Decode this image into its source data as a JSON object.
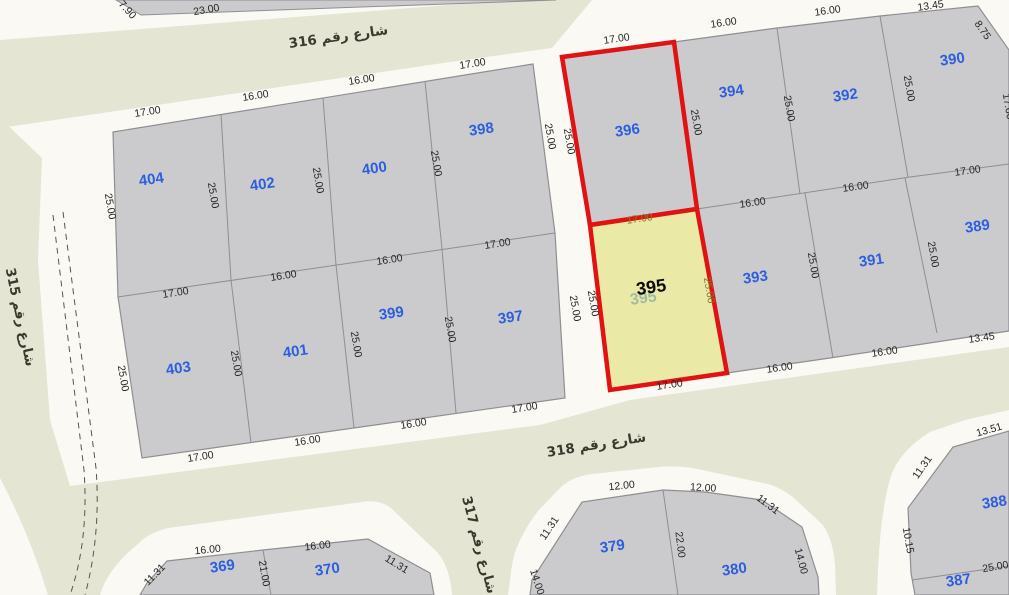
{
  "map": {
    "colors": {
      "background": "#f8f7f2",
      "street_green": "#e4e6d3",
      "block_pad_white": "#faf9f4",
      "parcel_fill": "#cbcbcd",
      "parcel_stroke": "#8f8f92",
      "highlight_red": "#e01212",
      "selected_yellow": "#ebe9a6",
      "parcel_number_blue": "#2d5ee0",
      "dimension_text": "#262626",
      "olive_dimension_text": "#7e7e2e",
      "street_text": "#3a392d"
    },
    "streets": [
      {
        "number": "316",
        "name": "شارع رقم 316",
        "x": 339,
        "y": 41,
        "rot": -8
      },
      {
        "number": "315",
        "name": "شارع رقم 315",
        "x": 16,
        "y": 318,
        "rot": 78
      },
      {
        "number": "318",
        "name": "شارع رقم 318",
        "x": 597,
        "y": 449,
        "rot": -9
      },
      {
        "number": "317",
        "name": "شارع رقم 317",
        "x": 475,
        "y": 546,
        "rot": 75
      }
    ],
    "parcels": [
      {
        "num": "404",
        "x": 152,
        "y": 184
      },
      {
        "num": "402",
        "x": 263,
        "y": 189
      },
      {
        "num": "400",
        "x": 375,
        "y": 173
      },
      {
        "num": "398",
        "x": 482,
        "y": 134
      },
      {
        "num": "403",
        "x": 179,
        "y": 373
      },
      {
        "num": "401",
        "x": 296,
        "y": 356
      },
      {
        "num": "399",
        "x": 392,
        "y": 318
      },
      {
        "num": "397",
        "x": 511,
        "y": 322
      },
      {
        "num": "396",
        "x": 628,
        "y": 135
      },
      {
        "num": "394",
        "x": 732,
        "y": 96
      },
      {
        "num": "392",
        "x": 846,
        "y": 100
      },
      {
        "num": "390",
        "x": 953,
        "y": 64
      },
      {
        "num": "393",
        "x": 756,
        "y": 282
      },
      {
        "num": "391",
        "x": 872,
        "y": 265
      },
      {
        "num": "389",
        "x": 978,
        "y": 231
      },
      {
        "num": "369",
        "x": 223,
        "y": 571
      },
      {
        "num": "370",
        "x": 328,
        "y": 574
      },
      {
        "num": "379",
        "x": 613,
        "y": 551
      },
      {
        "num": "380",
        "x": 735,
        "y": 574
      },
      {
        "num": "387",
        "x": 959,
        "y": 585
      },
      {
        "num": "388",
        "x": 995,
        "y": 507
      }
    ],
    "selected": {
      "number": "395",
      "x": 652,
      "y": 293,
      "ghost_number": "395",
      "ghost_x": 644,
      "ghost_y": 303
    },
    "dims": [
      {
        "t": "7.90",
        "x": 125,
        "y": 12,
        "r": 48
      },
      {
        "t": "23.00",
        "x": 207,
        "y": 13,
        "r": -10
      },
      {
        "t": "17.00",
        "x": 148,
        "y": 115,
        "r": -9
      },
      {
        "t": "16.00",
        "x": 256,
        "y": 99,
        "r": -9
      },
      {
        "t": "16.00",
        "x": 362,
        "y": 83,
        "r": -9
      },
      {
        "t": "17.00",
        "x": 473,
        "y": 67,
        "r": -9
      },
      {
        "t": "25.00",
        "x": 107,
        "y": 207,
        "r": 80
      },
      {
        "t": "25.00",
        "x": 210,
        "y": 196,
        "r": 80
      },
      {
        "t": "25.00",
        "x": 315,
        "y": 181,
        "r": 80
      },
      {
        "t": "25.00",
        "x": 433,
        "y": 164,
        "r": 80
      },
      {
        "t": "25.00",
        "x": 547,
        "y": 137,
        "r": 80
      },
      {
        "t": "17.00",
        "x": 176,
        "y": 296,
        "r": -9
      },
      {
        "t": "16.00",
        "x": 284,
        "y": 279,
        "r": -9
      },
      {
        "t": "16.00",
        "x": 390,
        "y": 263,
        "r": -9
      },
      {
        "t": "17.00",
        "x": 498,
        "y": 247,
        "r": -9
      },
      {
        "t": "25.00",
        "x": 120,
        "y": 379,
        "r": 80
      },
      {
        "t": "25.00",
        "x": 233,
        "y": 364,
        "r": 80
      },
      {
        "t": "25.00",
        "x": 353,
        "y": 345,
        "r": 80
      },
      {
        "t": "25.00",
        "x": 447,
        "y": 330,
        "r": 80
      },
      {
        "t": "25.00",
        "x": 572,
        "y": 309,
        "r": 80
      },
      {
        "t": "17.00",
        "x": 201,
        "y": 460,
        "r": -9
      },
      {
        "t": "16.00",
        "x": 308,
        "y": 444,
        "r": -9
      },
      {
        "t": "16.00",
        "x": 414,
        "y": 427,
        "r": -9
      },
      {
        "t": "17.00",
        "x": 525,
        "y": 411,
        "r": -9
      },
      {
        "t": "17.00",
        "x": 617,
        "y": 42,
        "r": -8
      },
      {
        "t": "16.00",
        "x": 724,
        "y": 26,
        "r": -8
      },
      {
        "t": "16.00",
        "x": 828,
        "y": 14,
        "r": -8
      },
      {
        "t": "13.45",
        "x": 931,
        "y": 9,
        "r": -8
      },
      {
        "t": "8.75",
        "x": 980,
        "y": 32,
        "r": 55
      },
      {
        "t": "25.00",
        "x": 566,
        "y": 142,
        "r": 80
      },
      {
        "t": "25.00",
        "x": 693,
        "y": 123,
        "r": 80
      },
      {
        "t": "25.00",
        "x": 786,
        "y": 109,
        "r": 80
      },
      {
        "t": "25.00",
        "x": 906,
        "y": 89,
        "r": 80
      },
      {
        "t": "17.00",
        "x": 1005,
        "y": 107,
        "r": 80
      },
      {
        "t": "16.00",
        "x": 753,
        "y": 206,
        "r": -8
      },
      {
        "t": "16.00",
        "x": 856,
        "y": 190,
        "r": -8
      },
      {
        "t": "17.00",
        "x": 968,
        "y": 174,
        "r": -8
      },
      {
        "t": "17.00",
        "x": 640,
        "y": 222,
        "r": -8,
        "c": "olive"
      },
      {
        "t": "25.00",
        "x": 706,
        "y": 291,
        "r": 80,
        "c": "olive"
      },
      {
        "t": "25.00",
        "x": 590,
        "y": 304,
        "r": 80
      },
      {
        "t": "25.00",
        "x": 810,
        "y": 266,
        "r": 80
      },
      {
        "t": "25.00",
        "x": 930,
        "y": 255,
        "r": 80
      },
      {
        "t": "17.00",
        "x": 670,
        "y": 388,
        "r": -8
      },
      {
        "t": "16.00",
        "x": 780,
        "y": 371,
        "r": -8
      },
      {
        "t": "16.00",
        "x": 885,
        "y": 355,
        "r": -8
      },
      {
        "t": "13.45",
        "x": 982,
        "y": 341,
        "r": -8
      },
      {
        "t": "13.51",
        "x": 990,
        "y": 433,
        "r": -16
      },
      {
        "t": "11.31",
        "x": 925,
        "y": 469,
        "r": -55
      },
      {
        "t": "10.15",
        "x": 905,
        "y": 541,
        "r": 80
      },
      {
        "t": "25.00",
        "x": 996,
        "y": 570,
        "r": -10
      },
      {
        "t": "16.00",
        "x": 208,
        "y": 553,
        "r": -6
      },
      {
        "t": "16.00",
        "x": 318,
        "y": 549,
        "r": -7
      },
      {
        "t": "11.31",
        "x": 157,
        "y": 577,
        "r": -46
      },
      {
        "t": "11.31",
        "x": 395,
        "y": 567,
        "r": 32
      },
      {
        "t": "21.00",
        "x": 261,
        "y": 574,
        "r": 80
      },
      {
        "t": "12.00",
        "x": 622,
        "y": 489,
        "r": -6
      },
      {
        "t": "12.00",
        "x": 703,
        "y": 491,
        "r": 3
      },
      {
        "t": "11.31",
        "x": 552,
        "y": 530,
        "r": -56
      },
      {
        "t": "11.31",
        "x": 766,
        "y": 507,
        "r": 37
      },
      {
        "t": "22.00",
        "x": 677,
        "y": 545,
        "r": 83
      },
      {
        "t": "14.00",
        "x": 534,
        "y": 583,
        "r": 72
      },
      {
        "t": "14.00",
        "x": 798,
        "y": 562,
        "r": 75
      }
    ]
  }
}
